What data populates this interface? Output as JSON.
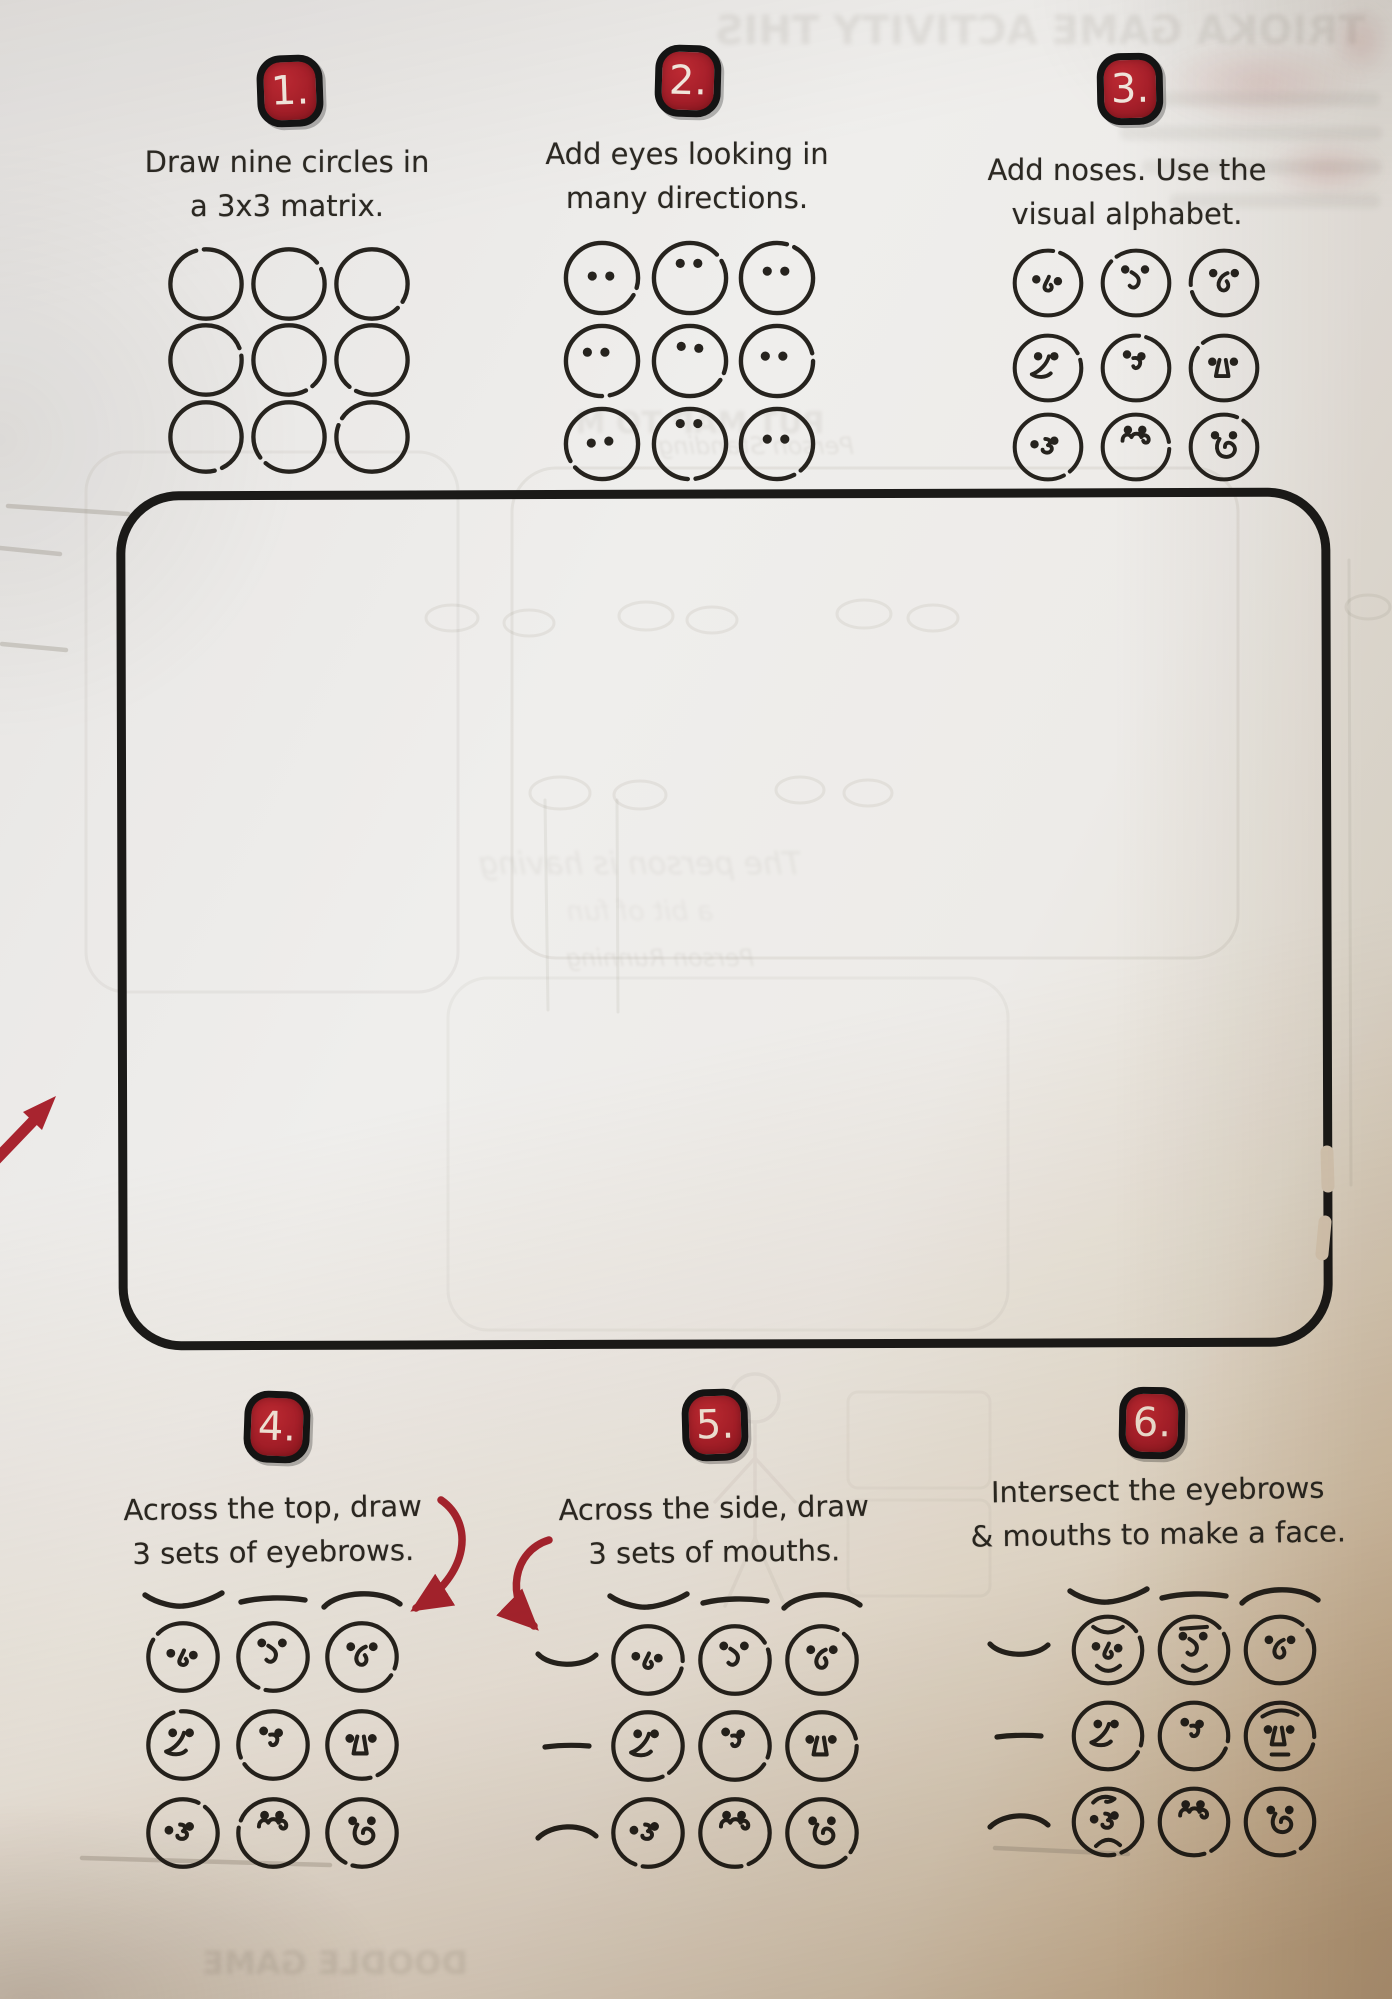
{
  "colors": {
    "ink": "#26231e",
    "badge_red": "#a81f2a",
    "arrow_red": "#a8242f",
    "paper": "#eceae7",
    "paper_shadow": "#cbb79c",
    "ghost": "#8f897e",
    "pencil": "#a9a49a"
  },
  "eye_presets": {
    "hook": [
      27,
      36,
      51,
      38
    ],
    "swoosh": [
      28,
      25,
      50,
      25
    ],
    "loop": [
      28,
      29,
      52,
      29
    ],
    "wedge": [
      29,
      27,
      47,
      27
    ],
    "curl": [
      30,
      25,
      46,
      27
    ],
    "trapezoid": [
      27,
      33,
      51,
      33
    ],
    "zigzag": [
      25,
      37,
      47,
      33
    ],
    "curly": [
      31,
      21,
      47,
      21
    ],
    "swoop": [
      30,
      27,
      50,
      27
    ]
  },
  "steps": [
    {
      "badge": "1.",
      "badge_center": [
        290,
        92
      ],
      "instruction": [
        "Draw nine circles in",
        "a 3x3 matrix."
      ],
      "text_center_x": 287,
      "text_top": 140,
      "grid": {
        "cols": [
          206,
          289,
          372
        ],
        "rows": [
          284,
          360,
          437
        ],
        "diameter": 77,
        "cells": [
          [
            null,
            null,
            null
          ],
          [
            null,
            null,
            null
          ],
          [
            null,
            null,
            null
          ]
        ]
      }
    },
    {
      "badge": "2.",
      "badge_center": [
        688,
        82
      ],
      "instruction": [
        "Add eyes looking in",
        "many directions."
      ],
      "text_center_x": 687,
      "text_top": 132,
      "grid": {
        "cols": [
          602,
          690,
          777
        ],
        "rows": [
          278,
          361,
          444
        ],
        "diameter": 78,
        "cells": [
          [
            {
              "eyes": [
                30,
                38,
                48,
                38
              ]
            },
            {
              "eyes": [
                30,
                25,
                48,
                25
              ]
            },
            {
              "eyes": [
                30,
                33,
                48,
                33
              ]
            }
          ],
          [
            {
              "eyes": [
                25,
                31,
                43,
                31
              ]
            },
            {
              "eyes": [
                31,
                25,
                49,
                27
              ]
            },
            {
              "eyes": [
                28,
                35,
                46,
                35
              ]
            }
          ],
          [
            {
              "eyes": [
                29,
                39,
                47,
                37
              ]
            },
            {
              "eyes": [
                30,
                19,
                48,
                19
              ]
            },
            {
              "eyes": [
                30,
                35,
                48,
                35
              ]
            }
          ]
        ]
      }
    },
    {
      "badge": "3.",
      "badge_center": [
        1130,
        90
      ],
      "instruction": [
        "Add noses. Use the",
        "visual alphabet."
      ],
      "text_center_x": 1127,
      "text_top": 148,
      "grid": {
        "cols": [
          1048,
          1136,
          1224
        ],
        "rows": [
          283,
          368,
          447
        ],
        "diameter": 72,
        "cells": [
          [
            {
              "nose": "hook"
            },
            {
              "nose": "swoosh"
            },
            {
              "nose": "loop"
            }
          ],
          [
            {
              "nose": "wedge"
            },
            {
              "nose": "curl"
            },
            {
              "nose": "trapezoid"
            }
          ],
          [
            {
              "nose": "zigzag"
            },
            {
              "nose": "curly"
            },
            {
              "nose": "swoop"
            }
          ]
        ]
      }
    },
    {
      "badge": "4.",
      "badge_center": [
        277,
        1428
      ],
      "instruction": [
        "Across the top, draw",
        "3 sets of eyebrows."
      ],
      "text_center_x": 273,
      "text_top": 1486,
      "brow_row": {
        "y": 1601,
        "types": [
          "sad",
          "flat",
          "arch"
        ]
      },
      "grid": {
        "cols": [
          183,
          273,
          362
        ],
        "rows": [
          1657,
          1745,
          1833
        ],
        "diameter": 75,
        "cells": [
          [
            {
              "nose": "hook"
            },
            {
              "nose": "swoosh"
            },
            {
              "nose": "loop"
            }
          ],
          [
            {
              "nose": "wedge"
            },
            {
              "nose": "curl"
            },
            {
              "nose": "trapezoid"
            }
          ],
          [
            {
              "nose": "zigzag"
            },
            {
              "nose": "curly"
            },
            {
              "nose": "swoop"
            }
          ]
        ]
      }
    },
    {
      "badge": "5.",
      "badge_center": [
        715,
        1426
      ],
      "instruction": [
        "Across the side, draw",
        "3 sets of mouths."
      ],
      "text_center_x": 714,
      "text_top": 1486,
      "brow_row": {
        "y": 1602,
        "types": [
          "sad",
          "flat",
          "arch"
        ]
      },
      "mouth_col": {
        "x": 567,
        "types": [
          "smile",
          "flat",
          "frown"
        ]
      },
      "grid": {
        "cols": [
          648,
          735,
          822
        ],
        "rows": [
          1660,
          1746,
          1833
        ],
        "diameter": 75,
        "cells": [
          [
            {
              "nose": "hook"
            },
            {
              "nose": "swoosh"
            },
            {
              "nose": "loop"
            }
          ],
          [
            {
              "nose": "wedge"
            },
            {
              "nose": "curl"
            },
            {
              "nose": "trapezoid"
            }
          ],
          [
            {
              "nose": "zigzag"
            },
            {
              "nose": "curly"
            },
            {
              "nose": "swoop"
            }
          ]
        ]
      }
    },
    {
      "badge": "6.",
      "badge_center": [
        1152,
        1424
      ],
      "instruction": [
        "Intersect the eyebrows",
        "& mouths to make a face."
      ],
      "text_center_x": 1158,
      "text_top": 1468,
      "brow_row": {
        "y": 1597,
        "types": [
          "sad",
          "flat",
          "arch"
        ]
      },
      "mouth_col": {
        "x": 1019,
        "types": [
          "smile",
          "flat",
          "frown"
        ]
      },
      "grid": {
        "cols": [
          1108,
          1194,
          1280
        ],
        "rows": [
          1650,
          1736,
          1822
        ],
        "diameter": 74,
        "cells": [
          [
            {
              "nose": "hook",
              "brow": "fringe",
              "mouth": "smile"
            },
            {
              "nose": "swoosh",
              "brow": "line",
              "mouth": "smile"
            },
            {
              "nose": "loop"
            }
          ],
          [
            {
              "nose": "wedge"
            },
            {
              "nose": "curl"
            },
            {
              "nose": "trapezoid",
              "brow": "arch2",
              "mouth": "flat"
            }
          ],
          [
            {
              "nose": "zigzag",
              "brow": "curlb",
              "mouth": "frown"
            },
            {
              "nose": "curly"
            },
            {
              "nose": "swoop"
            }
          ]
        ]
      }
    }
  ],
  "practice_box": {
    "x": 122,
    "y": 494,
    "w": 1205,
    "h": 850,
    "radius": 58,
    "gaps": [
      [
        1327,
        1152,
        1328,
        1186
      ],
      [
        1325,
        1222,
        1322,
        1254
      ]
    ]
  },
  "arrows": [
    {
      "name": "margin-arrow-up-right",
      "kind": "straight",
      "line": [
        -12,
        1168,
        36,
        1118
      ],
      "head": [
        56,
        1096,
        42,
        1130,
        23,
        1112
      ]
    },
    {
      "name": "step4-arrow",
      "kind": "curve",
      "path": "M441,1500 C474,1523 470,1574 416,1608"
    },
    {
      "name": "step5-arrow",
      "kind": "curve",
      "path": "M549,1540 C513,1551 505,1598 534,1626"
    }
  ],
  "bleed_through": {
    "texts": [
      {
        "t": "TRIOKA GAME ACTIVITY THIS",
        "x": 1040,
        "y": 8,
        "size": 40,
        "o": 0.15,
        "b": 2.5,
        "w": 720,
        "bold": 1
      },
      {
        "t": "PUT MAP TO M",
        "x": 700,
        "y": 406,
        "size": 30,
        "o": 0.12,
        "b": 1.6,
        "w": 500,
        "bold": 1
      },
      {
        "t": "Person Standing",
        "x": 756,
        "y": 432,
        "size": 24,
        "o": 0.13,
        "b": 1.2,
        "w": 300,
        "i": 1
      },
      {
        "t": "The person is having",
        "x": 640,
        "y": 846,
        "size": 31,
        "o": 0.11,
        "b": 1.5,
        "w": 440,
        "i": 1
      },
      {
        "t": "a bit of fun",
        "x": 640,
        "y": 896,
        "size": 27,
        "o": 0.09,
        "b": 1.6,
        "w": 440,
        "i": 1
      },
      {
        "t": "Person Running",
        "x": 660,
        "y": 944,
        "size": 24,
        "o": 0.12,
        "b": 1.2,
        "w": 300,
        "i": 1
      },
      {
        "t": "DOODLE GAME",
        "x": 335,
        "y": 1944,
        "size": 32,
        "o": 0.18,
        "b": 2.2,
        "w": 420,
        "bold": 1
      }
    ],
    "rects": [
      [
        512,
        468,
        726,
        490,
        44,
        0.13
      ],
      [
        86,
        452,
        372,
        540,
        40,
        0.1
      ],
      [
        448,
        978,
        560,
        352,
        40,
        0.08
      ],
      [
        848,
        1392,
        142,
        96,
        10,
        0.07
      ],
      [
        848,
        1500,
        142,
        96,
        10,
        0.07
      ]
    ],
    "ellipses": [
      [
        452,
        618,
        26,
        13
      ],
      [
        529,
        623,
        25,
        13
      ],
      [
        646,
        616,
        27,
        14
      ],
      [
        712,
        620,
        25,
        13
      ],
      [
        864,
        614,
        27,
        14
      ],
      [
        933,
        618,
        25,
        13
      ],
      [
        560,
        793,
        30,
        16
      ],
      [
        640,
        795,
        26,
        14
      ],
      [
        800,
        790,
        24,
        13
      ],
      [
        868,
        793,
        24,
        13
      ],
      [
        1368,
        607,
        22,
        12
      ]
    ],
    "vlines": [
      [
        545,
        800,
        548,
        1010
      ],
      [
        617,
        800,
        618,
        1012
      ],
      [
        1349,
        560,
        1351,
        1185
      ]
    ],
    "stick_figure": [
      755,
      1398
    ],
    "pencil": [
      [
        8,
        506,
        128,
        514
      ],
      [
        0,
        548,
        60,
        554
      ],
      [
        2,
        644,
        66,
        650
      ],
      [
        995,
        1848,
        1128,
        1854
      ],
      [
        82,
        1858,
        330,
        1865
      ]
    ],
    "gray_bars": [
      [
        1150,
        92,
        230,
        14
      ],
      [
        1120,
        126,
        262,
        14
      ],
      [
        1142,
        160,
        240,
        14
      ],
      [
        1170,
        194,
        210,
        14
      ]
    ],
    "red_blobs": [
      [
        1155,
        40,
        210,
        85
      ],
      [
        1268,
        138,
        118,
        62
      ],
      [
        1328,
        4,
        64,
        74
      ]
    ]
  }
}
